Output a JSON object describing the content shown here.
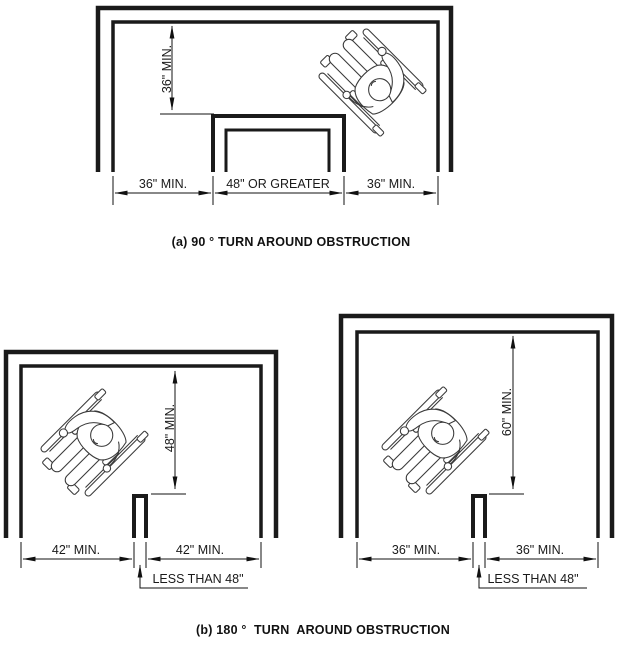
{
  "page": {
    "background": "#ffffff",
    "line_color": "#1a1a1a"
  },
  "captions": {
    "a": "(a) 90 ° TURN AROUND OBSTRUCTION",
    "b": "(b) 180 °  TURN  AROUND OBSTRUCTION"
  },
  "diagram_a": {
    "vertical_dim": "36\" MIN.",
    "bottom_dims": [
      "36\" MIN.",
      "48\" OR GREATER",
      "36\" MIN."
    ]
  },
  "diagram_b_left": {
    "vertical_dim": "48\" MIN.",
    "left_dim": "42\" MIN.",
    "right_dim": "42\" MIN.",
    "obstruction_note": "LESS THAN 48\""
  },
  "diagram_b_right": {
    "vertical_dim": "60\" MIN.",
    "left_dim": "36\" MIN.",
    "right_dim": "36\" MIN.",
    "obstruction_note": "LESS THAN 48\""
  }
}
